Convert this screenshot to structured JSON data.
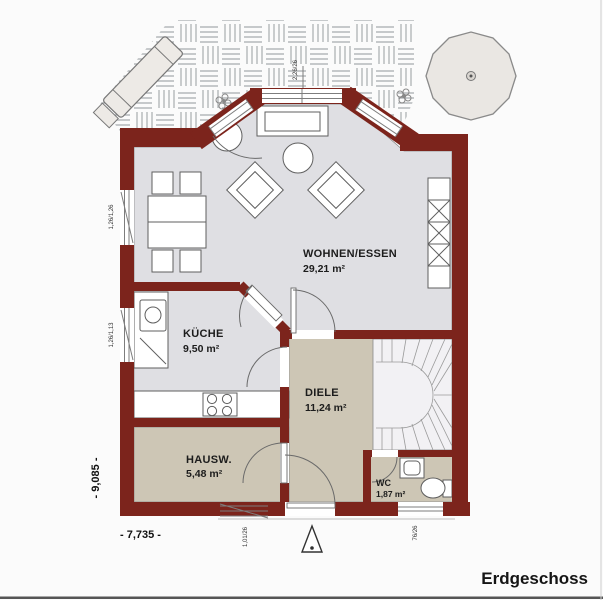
{
  "title": "Erdgeschoss",
  "rooms": [
    {
      "id": "wohnen",
      "name": "WOHNEN/ESSEN",
      "area": "29,21 m²"
    },
    {
      "id": "kueche",
      "name": "KÜCHE",
      "area": "9,50 m²"
    },
    {
      "id": "diele",
      "name": "DIELE",
      "area": "11,24 m²"
    },
    {
      "id": "hausw",
      "name": "HAUSW.",
      "area": "5,48 m²"
    },
    {
      "id": "wc",
      "name": "WC",
      "area": "1,87 m²"
    }
  ],
  "dimensions": {
    "overall_width": "- 7,735 -",
    "overall_height": "- 9,085 -"
  },
  "annotations": {
    "window_top": "2,26/26",
    "window_left_upper": "1,26/1,26",
    "window_left_lower": "1,26/1,13",
    "entry_door": "1,01/26",
    "window_wc": "76/26"
  },
  "colors": {
    "wall": "#7c241c",
    "floor_living": "#dfdfe3",
    "floor_hall": "#cdc6b5",
    "floor_stair": "#f2f1f4",
    "terrace_line": "#a7abae"
  }
}
